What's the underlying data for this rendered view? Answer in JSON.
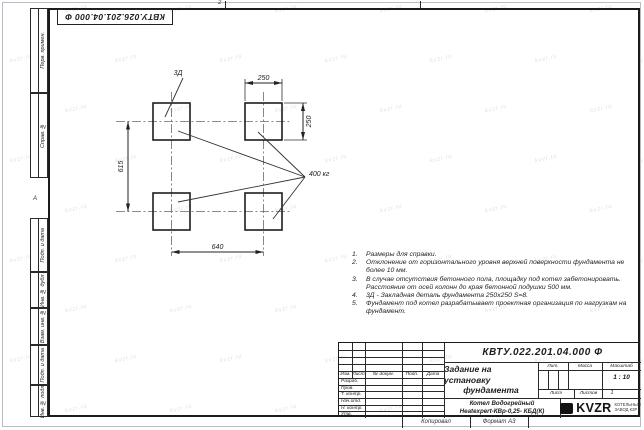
{
  "page": {
    "top_designation": "КВТУ.026.201.04.000 Ф",
    "zone_top": "2",
    "zone_left": "А",
    "kopiroval": "Копировал",
    "format": "Формат А3"
  },
  "watermark": {
    "text": "kvzr.ru"
  },
  "margin_stamps": [
    "Перв. примен.",
    "Справ. №",
    "Подп. и дата",
    "Инв. № дубл.",
    "Взам. инв. №",
    "Подп. и дата",
    "Инв. № подл."
  ],
  "drawing": {
    "callout_3d": "3Д",
    "dim_top": "250",
    "dim_right": "250",
    "dim_left": "615",
    "dim_bottom": "640",
    "load": "400 кг"
  },
  "notes": [
    {
      "num": "1.",
      "text": "Размеры для справки."
    },
    {
      "num": "2.",
      "text": "Отклонение от горизонтального уровня верхней поверхности фундамента не более 10 мм."
    },
    {
      "num": "3.",
      "text": "В случае отсутствия бетонного пола, площадку под котел забетонировать. Расстояние от осей колонн до края бетонной подушки 500 мм."
    },
    {
      "num": "4.",
      "text": "3Д - Закладная деталь фундамента 250х250 S=8."
    },
    {
      "num": "5.",
      "text": "Фундамент под котел разрабатывает проектная организация по нагрузкам на фундамент."
    }
  ],
  "title_block": {
    "doc_number": "КВТУ.022.201.04.000 Ф",
    "title_line1": "Задание на установку",
    "title_line2": "фундамента",
    "header_cols": [
      "Изм.",
      "Лист",
      "№ докум.",
      "Подп.",
      "Дата"
    ],
    "sign_rows": [
      "Разраб.",
      "Пров.",
      "Т. контр.",
      "Нач.отд.",
      "Н. контр.",
      "Утв."
    ],
    "lit_label": "Лит.",
    "mass_label": "Масса",
    "scale_label": "Масштаб",
    "scale_value": "1 : 10",
    "sheet_label": "Лист",
    "sheets_label": "Листов",
    "sheets_value": "1",
    "product_line1": "Котел Водогрейный",
    "product_line2": "Heatexpert-КВр-0,25- КБД(К)",
    "logo_text": "KVZR",
    "logo_sub1": "КОТЕЛЬНЫЙ",
    "logo_sub2": "ЗАВОД КЗР"
  }
}
